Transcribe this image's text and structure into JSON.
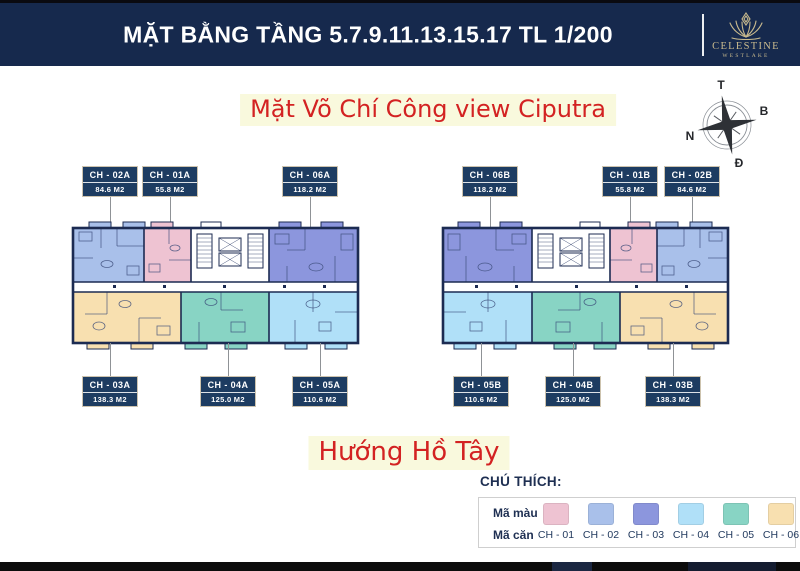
{
  "header": {
    "title": "MẶT BẰNG TẦNG 5.7.9.11.13.15.17 TL 1/200",
    "brand_name": "CELESTINE",
    "brand_sub": "WESTLAKE"
  },
  "annotations": {
    "street_side": "Mặt Võ Chí Công view Ciputra",
    "lake_side": "Hướng Hồ Tây"
  },
  "compass": {
    "top": "T",
    "right": "B",
    "left": "N",
    "bottom": "Đ"
  },
  "plans": {
    "left": {
      "top_labels": [
        {
          "code": "CH - 02A",
          "area": "84.6 M2"
        },
        {
          "code": "CH - 01A",
          "area": "55.8 M2"
        },
        {
          "code": "CH - 06A",
          "area": "118.2 M2"
        }
      ],
      "bottom_labels": [
        {
          "code": "CH - 03A",
          "area": "138.3 M2"
        },
        {
          "code": "CH - 04A",
          "area": "125.0 M2"
        },
        {
          "code": "CH - 05A",
          "area": "110.6 M2"
        }
      ]
    },
    "right": {
      "top_labels": [
        {
          "code": "CH - 06B",
          "area": "118.2 M2"
        },
        {
          "code": "CH - 01B",
          "area": "55.8 M2"
        },
        {
          "code": "CH - 02B",
          "area": "84.6 M2"
        }
      ],
      "bottom_labels": [
        {
          "code": "CH - 05B",
          "area": "110.6 M2"
        },
        {
          "code": "CH - 04B",
          "area": "125.0 M2"
        },
        {
          "code": "CH - 03B",
          "area": "138.3 M2"
        }
      ]
    }
  },
  "legend": {
    "title": "CHÚ THÍCH:",
    "row_color_label": "Mã màu",
    "row_unit_label": "Mã căn",
    "items": [
      {
        "code": "CH - 01",
        "color": "#eec3d2"
      },
      {
        "code": "CH - 02",
        "color": "#a9c0ea"
      },
      {
        "code": "CH - 03",
        "color": "#8c96dd"
      },
      {
        "code": "CH - 04",
        "color": "#b0e0f8"
      },
      {
        "code": "CH - 05",
        "color": "#88d4c4"
      },
      {
        "code": "CH - 06",
        "color": "#f8e0b0"
      }
    ]
  },
  "colors": {
    "header_navy": "#16294d",
    "label_navy": "#1d3c61",
    "wall_navy": "#1c2b52",
    "accent_red": "#d32222",
    "highlight_yellow": "#f9f9dd",
    "brand_tan": "#c9ba8e"
  }
}
